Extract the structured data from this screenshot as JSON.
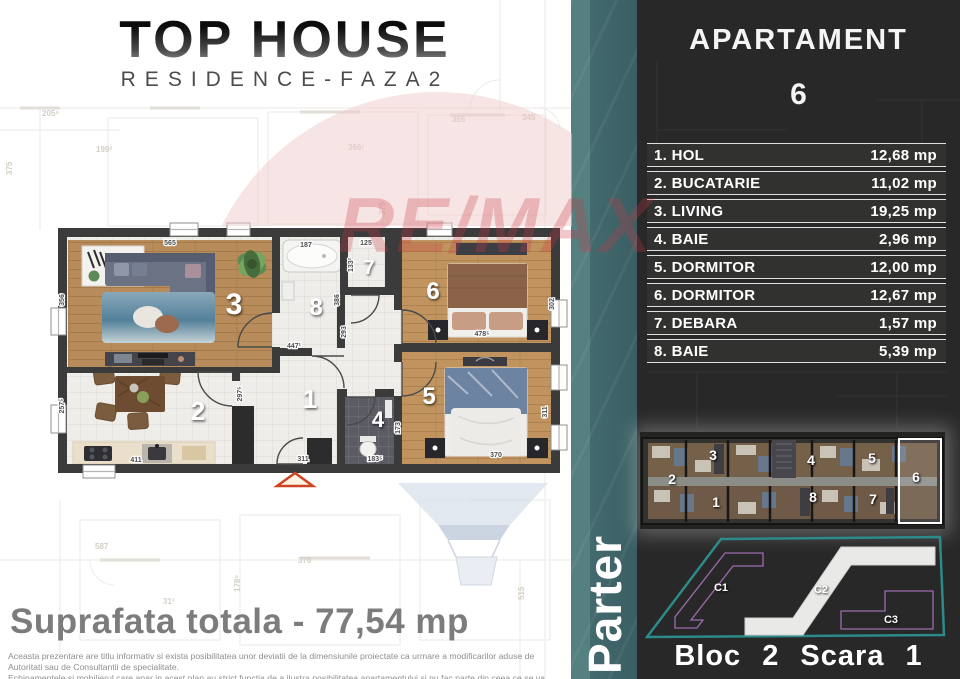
{
  "branding": {
    "title": "TOP HOUSE",
    "subtitle": "RESIDENCE-FAZA2"
  },
  "apartment": {
    "label": "APARTAMENT",
    "number": "6"
  },
  "rooms": [
    {
      "label": "1. HOL",
      "area": "12,68 mp"
    },
    {
      "label": "2. BUCATARIE",
      "area": "11,02 mp"
    },
    {
      "label": "3. LIVING",
      "area": "19,25 mp"
    },
    {
      "label": "4. BAIE",
      "area": "2,96 mp"
    },
    {
      "label": "5. DORMITOR",
      "area": "12,00 mp"
    },
    {
      "label": "6. DORMITOR",
      "area": "12,67 mp"
    },
    {
      "label": "7. DEBARA",
      "area": "1,57 mp"
    },
    {
      "label": "8. BAIE",
      "area": "5,39 mp"
    }
  ],
  "total_label": "Suprafata totala - 77,54 mp",
  "floor_name": "Parter",
  "bloc_label": "Bloc 2 Scara 1",
  "watermark_text": "RE/MAX",
  "disclaimer": {
    "line1": "Aceasta prezentare are titlu informativ si exista posibilitatea unor deviatii de la dimensiunile proiectate ca urmare a modificarilor aduse de Autoritati sau de Consultantii de specialitate.",
    "line2": "Echipamentele si mobilierul care apar in acest plan au strict functia de a ilustra posibilitatea apartamentului si nu fac parte din ceea ce se va preda."
  },
  "floorplan": {
    "room_numbers": [
      {
        "n": "3",
        "x": 186,
        "y": 98,
        "s": 30
      },
      {
        "n": "2",
        "x": 150,
        "y": 204,
        "s": 26
      },
      {
        "n": "1",
        "x": 262,
        "y": 192,
        "s": 26
      },
      {
        "n": "8",
        "x": 268,
        "y": 99,
        "s": 24
      },
      {
        "n": "7",
        "x": 321,
        "y": 58,
        "s": 20
      },
      {
        "n": "4",
        "x": 330,
        "y": 211,
        "s": 22
      },
      {
        "n": "6",
        "x": 385,
        "y": 83,
        "s": 24
      },
      {
        "n": "5",
        "x": 381,
        "y": 188,
        "s": 24
      }
    ],
    "dimensions": [
      {
        "t": "565",
        "x": 122,
        "y": 29
      },
      {
        "t": "356",
        "x": 16,
        "y": 84,
        "r": -90
      },
      {
        "t": "257⁵",
        "x": 16,
        "y": 190,
        "r": -90
      },
      {
        "t": "411",
        "x": 88,
        "y": 246
      },
      {
        "t": "297⁵",
        "x": 194,
        "y": 178,
        "r": -90
      },
      {
        "t": "447¹",
        "x": 246,
        "y": 132
      },
      {
        "t": "293",
        "x": 298,
        "y": 116,
        "r": -90
      },
      {
        "t": "187",
        "x": 258,
        "y": 31
      },
      {
        "t": "125",
        "x": 318,
        "y": 29
      },
      {
        "t": "133²",
        "x": 305,
        "y": 49,
        "r": -90
      },
      {
        "t": "386",
        "x": 291,
        "y": 84,
        "r": -90
      },
      {
        "t": "311",
        "x": 255,
        "y": 245
      },
      {
        "t": "183⁵",
        "x": 327,
        "y": 245
      },
      {
        "t": "173",
        "x": 352,
        "y": 212,
        "r": -90
      },
      {
        "t": "478⁵",
        "x": 434,
        "y": 120
      },
      {
        "t": "302",
        "x": 506,
        "y": 88,
        "r": -90
      },
      {
        "t": "370",
        "x": 448,
        "y": 241
      },
      {
        "t": "311",
        "x": 499,
        "y": 196,
        "r": -90
      }
    ]
  },
  "overview_numbers": [
    {
      "t": "2",
      "x": 32,
      "y": 52
    },
    {
      "t": "3",
      "x": 73,
      "y": 28
    },
    {
      "t": "4",
      "x": 171,
      "y": 33
    },
    {
      "t": "5",
      "x": 232,
      "y": 31
    },
    {
      "t": "6",
      "x": 276,
      "y": 50
    },
    {
      "t": "1",
      "x": 76,
      "y": 75
    },
    {
      "t": "8",
      "x": 173,
      "y": 70
    },
    {
      "t": "7",
      "x": 233,
      "y": 72
    }
  ],
  "site_labels": [
    {
      "t": "C1",
      "x": 76,
      "y": 58
    },
    {
      "t": "C2",
      "x": 176,
      "y": 60
    },
    {
      "t": "C3",
      "x": 246,
      "y": 90
    }
  ],
  "background_labels": [
    {
      "t": "205⁵",
      "x": 42,
      "y": 116
    },
    {
      "t": "199³",
      "x": 96,
      "y": 152
    },
    {
      "t": "375",
      "x": 12,
      "y": 175,
      "r": -90
    },
    {
      "t": "355",
      "x": 452,
      "y": 122
    },
    {
      "t": "375",
      "x": 385,
      "y": 215,
      "r": -90
    },
    {
      "t": "345",
      "x": 522,
      "y": 120
    },
    {
      "t": "366¹",
      "x": 348,
      "y": 150
    },
    {
      "t": "587",
      "x": 95,
      "y": 549
    },
    {
      "t": "178⁵",
      "x": 240,
      "y": 592,
      "r": -90
    },
    {
      "t": "31³",
      "x": 163,
      "y": 604
    },
    {
      "t": "515",
      "x": 524,
      "y": 600,
      "r": -90
    },
    {
      "t": "378",
      "x": 298,
      "y": 563
    }
  ],
  "colors": {
    "panel_bg": "#282828",
    "teal_strip": "#3a5e63",
    "site_outline_teal": "#2d8a8a",
    "site_outline_purple": "#9c6bb0",
    "remax_red": "#c93a45",
    "total_gray": "#7c7c7c"
  }
}
